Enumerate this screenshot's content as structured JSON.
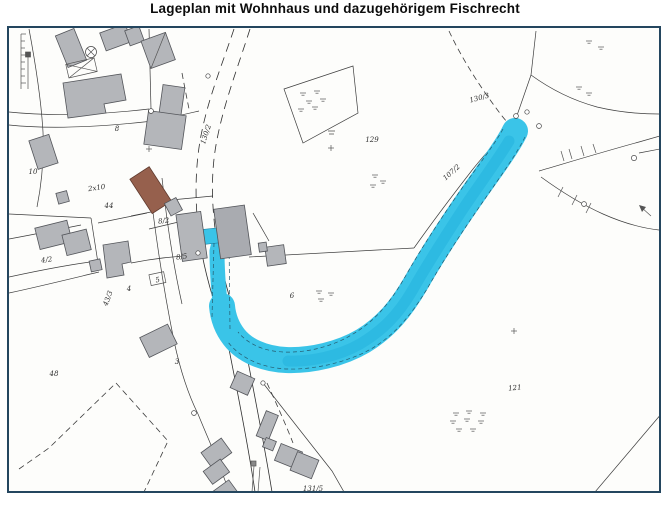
{
  "title": "Lageplan mit Wohnhaus und dazugehörigem Fischrecht",
  "map": {
    "border_color": "#24465f",
    "paper_color": "#fdfdfb",
    "line_color": "#3c3c3c",
    "building_color": "#b4b6ba",
    "accent_building_color": "#96604d",
    "stream_color": "#3ac4e8",
    "stream_parcel_label": "107/2",
    "parcel_labels": [
      {
        "text": "10",
        "x": 32,
        "y": 173,
        "r": 0
      },
      {
        "text": "8",
        "x": 116,
        "y": 130,
        "r": 0
      },
      {
        "text": "2x10",
        "x": 96,
        "y": 189,
        "r": -8
      },
      {
        "text": "44",
        "x": 108,
        "y": 207,
        "r": 0
      },
      {
        "text": "8/2",
        "x": 163,
        "y": 222,
        "r": -8
      },
      {
        "text": "8/5",
        "x": 181,
        "y": 258,
        "r": -8
      },
      {
        "text": "4/2",
        "x": 46,
        "y": 261,
        "r": -8
      },
      {
        "text": "4",
        "x": 128,
        "y": 290,
        "r": 0
      },
      {
        "text": "5",
        "x": 157,
        "y": 281,
        "r": -12
      },
      {
        "text": "43/3",
        "x": 109,
        "y": 298,
        "r": -70
      },
      {
        "text": "48",
        "x": 53,
        "y": 375,
        "r": 0
      },
      {
        "text": "3",
        "x": 176,
        "y": 363,
        "r": 0
      },
      {
        "text": "6",
        "x": 291,
        "y": 297,
        "r": 0
      },
      {
        "text": "130/2",
        "x": 207,
        "y": 134,
        "r": -72
      },
      {
        "text": "129",
        "x": 371,
        "y": 141,
        "r": 0
      },
      {
        "text": "130/3",
        "x": 479,
        "y": 99,
        "r": -15
      },
      {
        "text": "107/2",
        "x": 452,
        "y": 173,
        "r": -42
      },
      {
        "text": "121",
        "x": 514,
        "y": 389,
        "r": -5
      },
      {
        "text": "131/5",
        "x": 312,
        "y": 490,
        "r": 0
      }
    ]
  }
}
